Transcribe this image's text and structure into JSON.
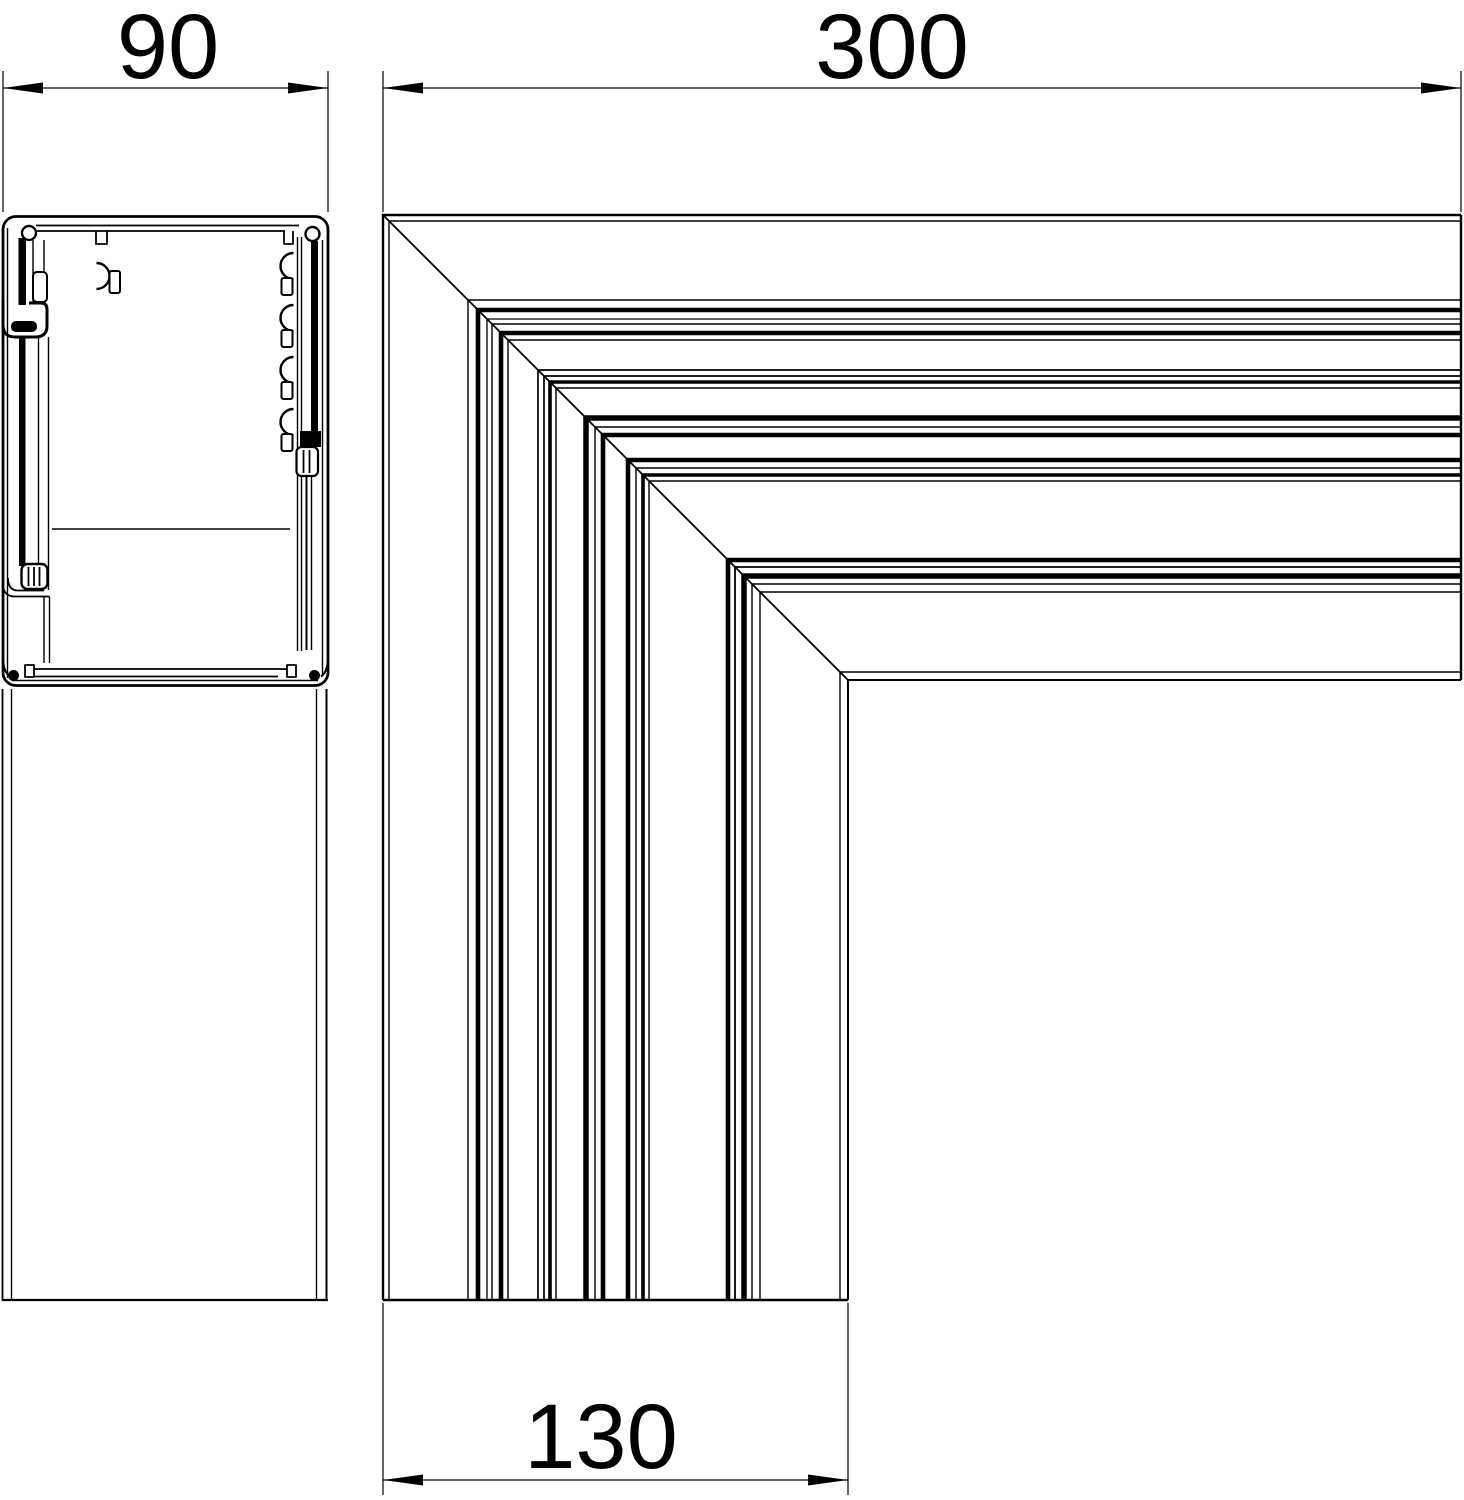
{
  "drawing": {
    "background_color": "#ffffff",
    "line_color": "#000000",
    "views": {
      "left": "trunking-cross-section",
      "right": "flat-angle-corner-top-view"
    },
    "dimensions": {
      "profile_width": {
        "label": "90"
      },
      "corner_length": {
        "label": "300"
      },
      "corner_leg_width": {
        "label": "130"
      }
    }
  }
}
